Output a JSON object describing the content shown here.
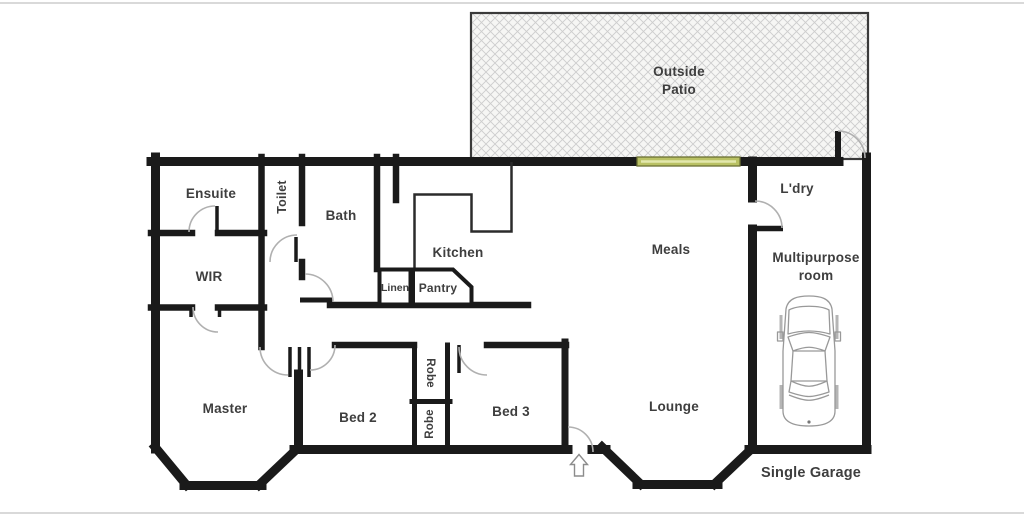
{
  "plan": {
    "title": "Single storey house floor plan",
    "rooms": {
      "outside_patio": {
        "line1": "Outside",
        "line2": "Patio"
      },
      "ensuite": "Ensuite",
      "toilet": "Toilet",
      "bath": "Bath",
      "wir": "WIR",
      "kitchen": "Kitchen",
      "linen": "Linen",
      "pantry": "Pantry",
      "meals": "Meals",
      "ldry": "L'dry",
      "multipurpose": {
        "line1": "Multipurpose",
        "line2": "room"
      },
      "master": "Master",
      "bed2": "Bed 2",
      "bed3": "Bed 3",
      "robe_upper": "Robe",
      "robe_lower": "Robe",
      "lounge": "Lounge",
      "garage": "Single Garage"
    },
    "icons": {
      "car": "car-top-view",
      "entry_arrow": "entry-direction-arrow",
      "sliding_door": "glass-sliding-door"
    },
    "colors": {
      "wall": "#1a1a1a",
      "label": "#3e3e3e",
      "door_arc": "#b0b0b0",
      "sliding_door_fill": "#b9c164",
      "sliding_door_border": "#6b7034",
      "sliding_door_highlight": "#e3e8ad",
      "patio_fill": "#f6f6f4",
      "patio_hatch_line": "#cdcdcd",
      "patio_border": "#3a3a3a",
      "car_outline": "#999999",
      "arrow_outline": "#8c8c8c"
    }
  }
}
